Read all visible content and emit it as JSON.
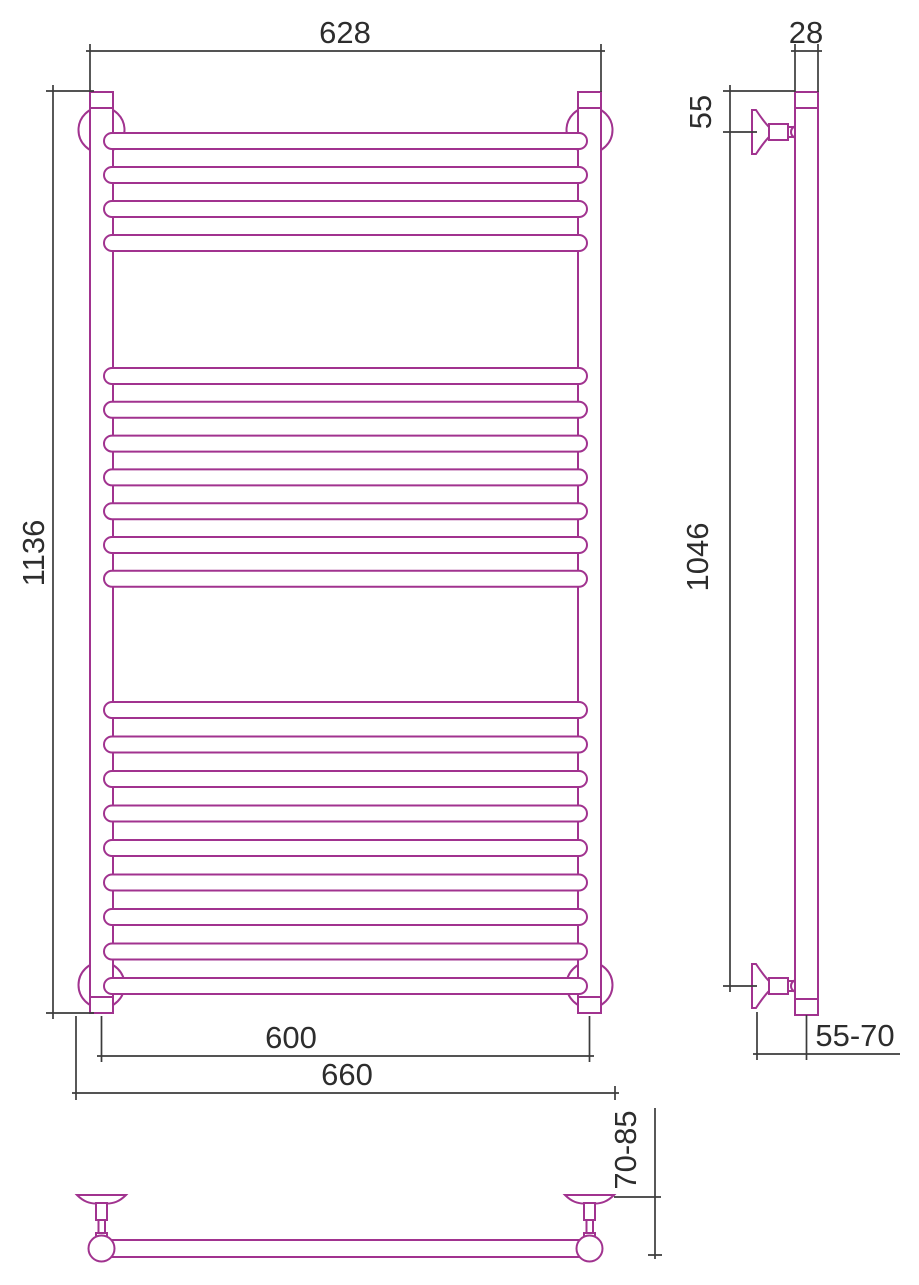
{
  "drawing": {
    "title": "heated-towel-rail-dimension-drawing",
    "labels": {
      "front_width": "628",
      "front_height": "1136",
      "axis_width": "600",
      "mount_width": "660",
      "tube_diameter": "28",
      "top_offset": "55",
      "bracket_span": "1046",
      "wall_depth": "55-70",
      "mount_depth": "70-85"
    },
    "colors": {
      "outline": "#a1338f",
      "dimension": "#3c3c3c",
      "background": "#ffffff"
    },
    "tubes": {
      "x": 104,
      "width": 483,
      "height": 16,
      "radius": 8,
      "groups": [
        {
          "start": 133,
          "spacing": 34.0,
          "count": 4
        },
        {
          "start": 368,
          "spacing": 33.8,
          "count": 7
        },
        {
          "start": 702,
          "spacing": 34.5,
          "count": 9
        }
      ]
    }
  }
}
